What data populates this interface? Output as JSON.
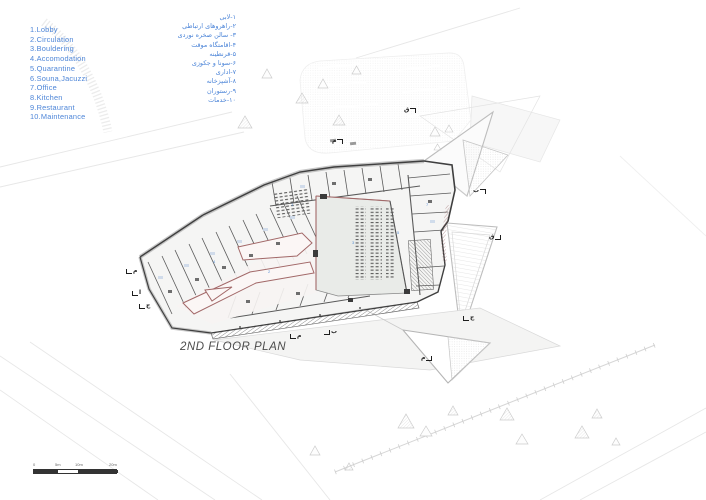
{
  "page": {
    "title": "2ND FLOOR PLAN"
  },
  "legend_en": {
    "items": [
      "1.Lobby",
      "2.Circulation",
      "3.Bouldering",
      "4.Accomodation",
      "5.Quarantine",
      "6.Souna,Jacuzzi",
      "7.Office",
      "8.Kitchen",
      "9.Restaurant",
      "10.Maintenance"
    ]
  },
  "legend_fa": {
    "items": [
      "۱-لابی",
      "۲-راهروهای ارتباطی",
      "۳- سالن صخره نوردی",
      "۴-اقامتگاه موقت",
      "۵-قرنطینه",
      "۶-سونا و جکوزی",
      "۷-اداری",
      "۸-آشپزخانه",
      "۹-رستوران",
      "۱۰-خدمات"
    ]
  },
  "scale_bar": {
    "labels": [
      "0",
      "5m",
      "10m",
      "20m"
    ]
  },
  "section_markers": [
    "م",
    "ق",
    "ب",
    "ق",
    "م",
    "ا",
    "ج",
    "م",
    "ب",
    "م",
    "ج"
  ],
  "room_labels": [
    "1",
    "2",
    "3",
    "4",
    "5",
    "7"
  ],
  "colors": {
    "legend_blue": "#4e86d8",
    "zone_red": "#a26868",
    "wall_dark": "#3f3f3f",
    "hall_floor": "#e9ebe8",
    "canopy_line": "#bdbdbd"
  }
}
